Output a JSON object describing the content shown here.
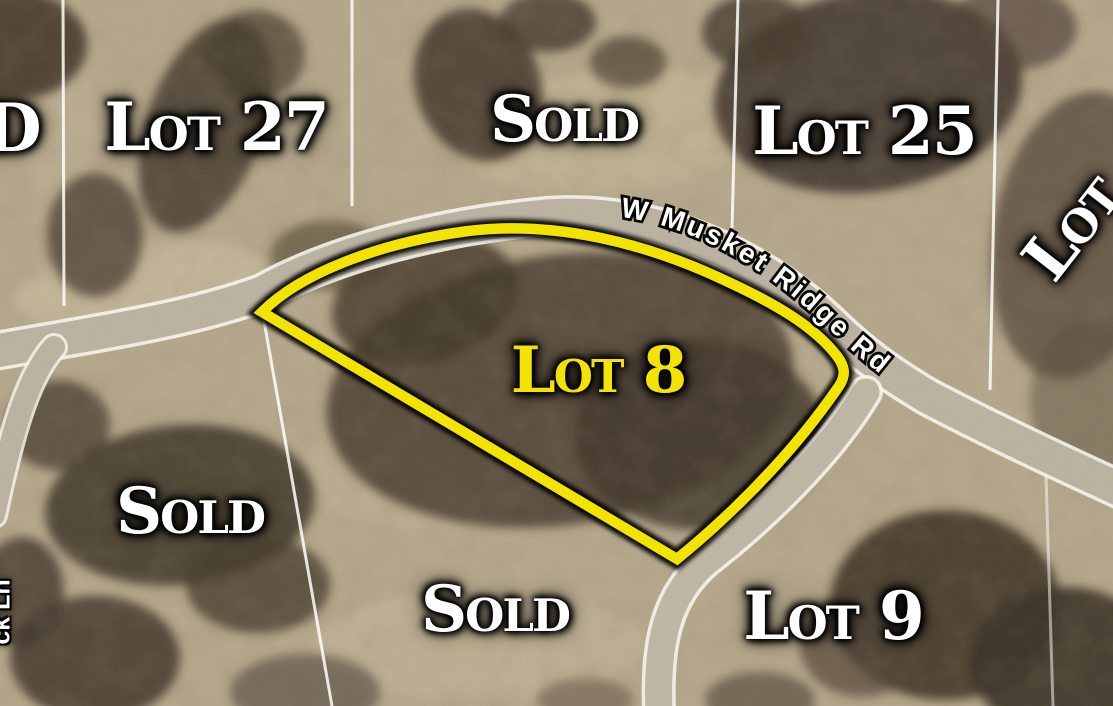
{
  "map": {
    "description": "Aerial subdivision lot map with highlighted available lot",
    "lot_labels": {
      "sold_partial_left": "D",
      "lot27": "Lot 27",
      "sold_top": "Sold",
      "lot25": "Lot 25",
      "lot_right_partial": "Lot",
      "lot8": "Lot 8",
      "sold_left": "Sold",
      "sold_bottom": "Sold",
      "lot9": "Lot 9"
    },
    "road_labels": {
      "main_road": "W Musket Ridge Rd",
      "side_lane_partial": "ck Ln"
    },
    "colors": {
      "highlight_boundary": "#f2e400",
      "label_text": "#ffffff",
      "label_glow": "#000000",
      "field": "#b7a98d",
      "trees": "#463b2e",
      "road_surface": "#bcb3a2",
      "road_edge": "#f8f6ef",
      "parcel_line": "#ffffff"
    }
  }
}
